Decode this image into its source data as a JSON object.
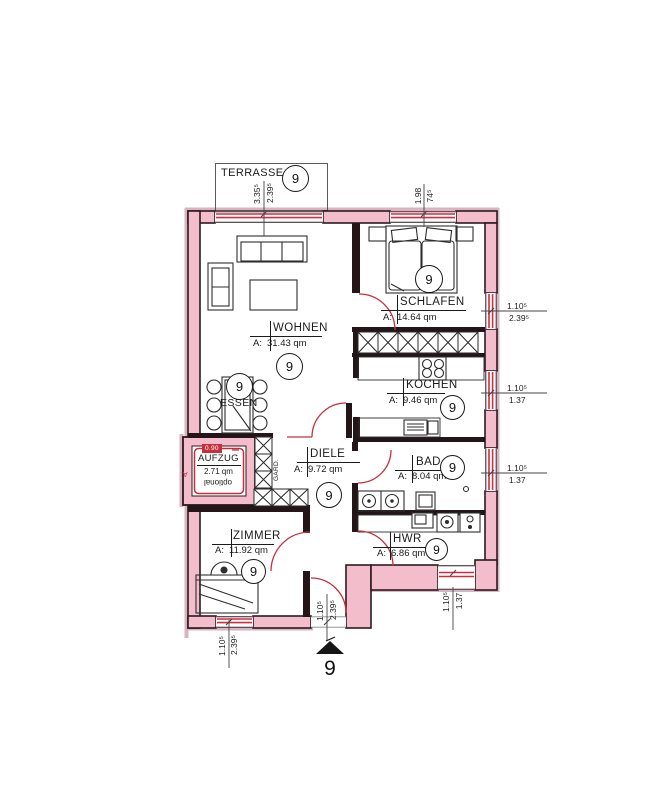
{
  "unit": {
    "number": "9"
  },
  "terrace": {
    "label": "TERRASSE"
  },
  "rooms": {
    "wohnen": {
      "name": "WOHNEN",
      "area_prefix": "A:",
      "area": "31.43 qm"
    },
    "schlafen": {
      "name": "SCHLAFEN",
      "area_prefix": "A:",
      "area": "14.64 qm"
    },
    "kochen": {
      "name": "KOCHEN",
      "area_prefix": "A:",
      "area": "9.46 qm"
    },
    "essen": {
      "name": "ESSEN"
    },
    "diele": {
      "name": "DIELE",
      "area_prefix": "A:",
      "area": "9.72 qm"
    },
    "bad": {
      "name": "BAD",
      "area_prefix": "A:",
      "area": "8.04 qm"
    },
    "zimmer": {
      "name": "ZIMMER",
      "area_prefix": "A:",
      "area": "11.92 qm"
    },
    "hwr": {
      "name": "HWR",
      "area_prefix": "A:",
      "area": "6.86 qm"
    },
    "aufzug": {
      "name": "AUFZUG",
      "area": "2.71 qm",
      "note": "optional",
      "door_tag": "0.90",
      "side_label": "A:"
    }
  },
  "closet_label": "GARD.",
  "dimensions": {
    "terrace_width": "3.35⁵",
    "terrace_depth": "2.39⁵",
    "schlafen_window_width": "1.98",
    "schlafen_window_sill": "74⁵",
    "right_top_width": "1.10⁵",
    "right_top_height": "2.39⁵",
    "right_mid_width": "1.10⁵",
    "right_mid_height": "1.37",
    "right_low_width": "1.10⁵",
    "right_low_height": "1.37",
    "hwr_window_width": "1.10⁵",
    "hwr_window_height": "1.37",
    "entrance_width": "1.10⁵",
    "entrance_height": "2.39⁵",
    "zimmer_window_width": "1.10⁵",
    "zimmer_window_height": "2.39⁵"
  },
  "colors": {
    "wall_fill": "#f3bdcb",
    "wall_halo": "#d9b3c0",
    "wall_outline": "#2c1a20",
    "interior_wall": "#241519",
    "accent_red": "#c5303d",
    "window_red": "#d22c3e"
  }
}
